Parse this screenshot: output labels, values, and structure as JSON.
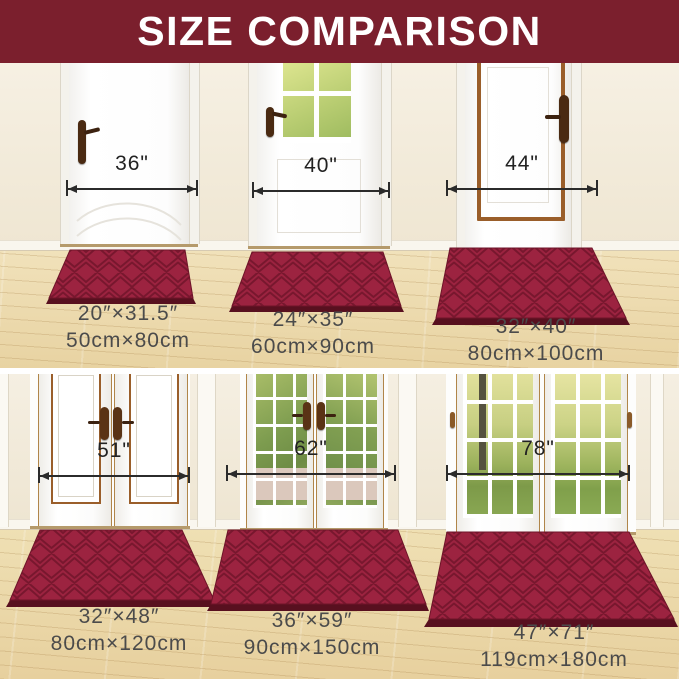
{
  "header": {
    "title": "SIZE COMPARISON"
  },
  "panels": [
    {
      "door_width_label": "36\"",
      "mat_size_in": "20″×31.5″",
      "mat_size_cm": "50cm×80cm"
    },
    {
      "door_width_label": "40\"",
      "mat_size_in": "24″×35″",
      "mat_size_cm": "60cm×90cm"
    },
    {
      "door_width_label": "44\"",
      "mat_size_in": "32″×40″",
      "mat_size_cm": "80cm×100cm"
    },
    {
      "door_width_label": "51\"",
      "mat_size_in": "32″×48″",
      "mat_size_cm": "80cm×120cm"
    },
    {
      "door_width_label": "62\"",
      "mat_size_in": "36″×59″",
      "mat_size_cm": "90cm×150cm"
    },
    {
      "door_width_label": "78\"",
      "mat_size_in": "47″×71″",
      "mat_size_cm": "119cm×180cm"
    }
  ],
  "colors": {
    "header_bg": "#7b1f2d",
    "mat": "#9c2340",
    "mat_groove": "#78172e",
    "wall": "#f3ecdd",
    "floor": "#ecd9ae",
    "door_trim_brown": "#9a5e2a"
  }
}
